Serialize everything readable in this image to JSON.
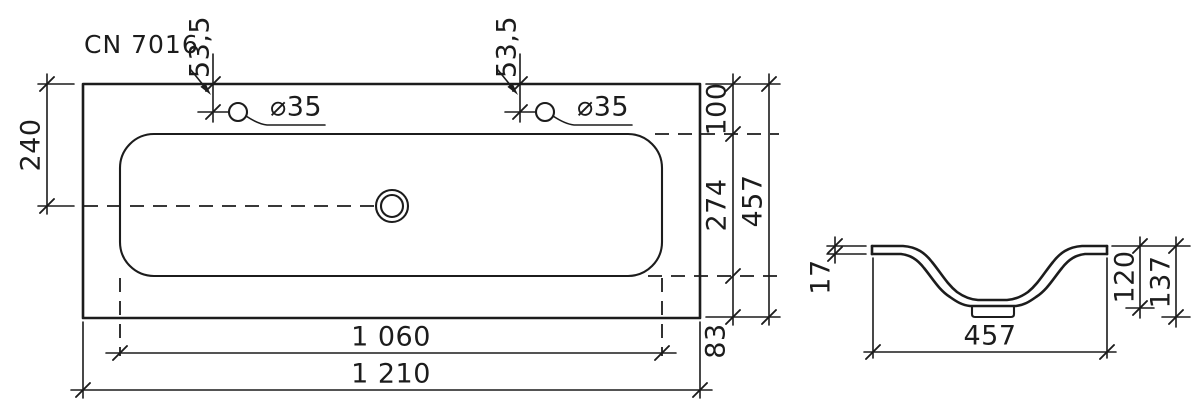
{
  "colors": {
    "ink": "#1c1c1c",
    "background": "#ffffff"
  },
  "drawing": {
    "model": "CN 7016",
    "plan_view": {
      "hole_offset_left": "53,5",
      "hole_offset_right": "53,5",
      "hole_diameter_left": "⌀35",
      "hole_diameter_right": "⌀35",
      "edge_to_centerline": "240",
      "edge_to_basin_top": "100",
      "basin_inner_depth": "274",
      "overall_depth": "457",
      "basin_to_bottom_edge": "83",
      "basin_width": "1 060",
      "overall_width": "1 210"
    },
    "section_view": {
      "rim_thickness": "17",
      "bowl_depth": "120",
      "overall_height": "137",
      "bowl_width": "457"
    }
  }
}
